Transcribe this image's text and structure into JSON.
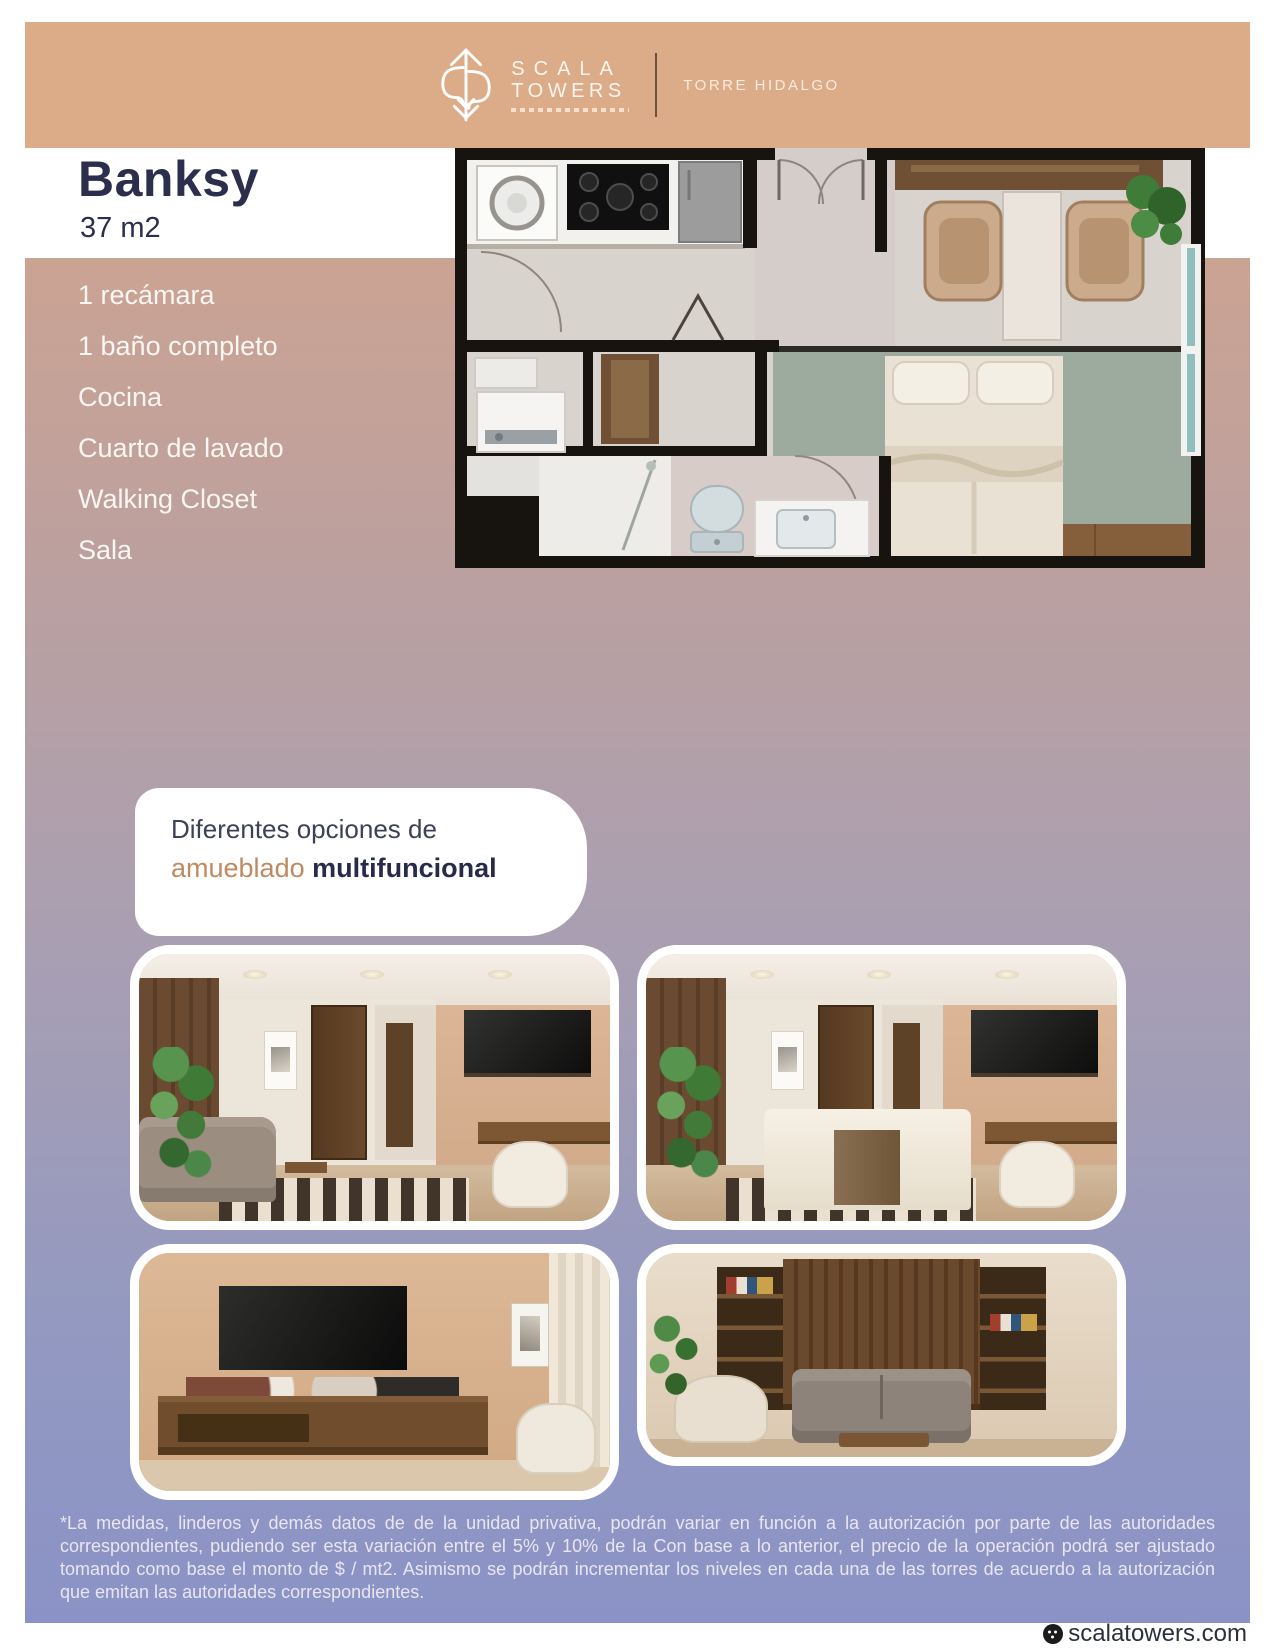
{
  "header": {
    "brand_line1": "SCALA",
    "brand_line2": "TOWERS",
    "tower_label": "TORRE HIDALGO"
  },
  "unit": {
    "name": "Banksy",
    "area": "37 m2"
  },
  "features": {
    "items": [
      "1 recámara",
      "1 baño completo",
      "Cocina",
      "Cuarto de lavado",
      "Walking Closet",
      "Sala"
    ]
  },
  "options": {
    "line1": "Diferentes opciones de",
    "highlight": "amueblado",
    "bold": "multifuncional"
  },
  "disclaimer": {
    "text": "*La medidas, linderos y demás datos de de la unidad privativa, podrán variar en función a la autorización por parte de las autoridades correspondientes, pudiendo ser esta variación entre el 5% y 10% de la Con base a lo anterior, el precio de la operación podrá ser ajustado tomando como base el monto de $ / mt2. Asimismo se podrán incrementar los niveles en cada una de las torres de acuerdo a la autorización que emitan las autoridades correspondientes."
  },
  "footer": {
    "website": "scalatowers.com"
  },
  "colors": {
    "header_band": "#dcab87",
    "gradient_top": "#cba393",
    "gradient_bottom": "#8b93c6",
    "navy": "#2b2e4d",
    "accent_tan": "#c08a61",
    "bedroom_sage": "#9dab9f",
    "window_teal": "#8fc0bd"
  }
}
